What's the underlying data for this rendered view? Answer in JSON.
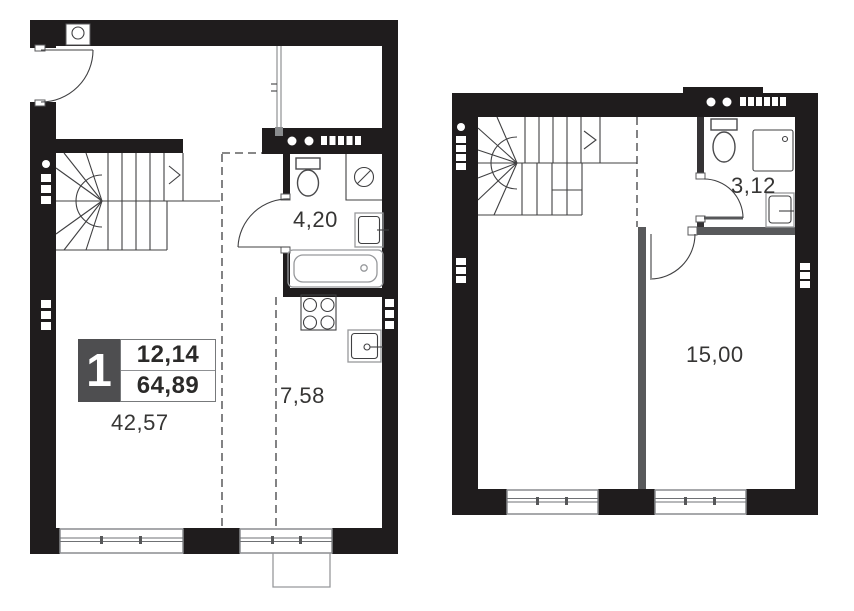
{
  "floor1": {
    "badge": {
      "unit_number": "1",
      "value_top": "12,14",
      "value_bottom": "64,89"
    },
    "living_area": "42,57",
    "kitchen_area": "7,58",
    "bathroom_area": "4,20"
  },
  "floor2": {
    "room_area": "15,00",
    "bathroom_area": "3,12"
  },
  "colors": {
    "wall_black": "#1f1c1d",
    "wall_gray": "#58595b",
    "fixture_wall": "#353335",
    "line_dark": "#404042",
    "fixture_dark": "#4a4a4c",
    "line_light": "#97999c",
    "window_frame": "#8a8c8f",
    "badge_bg": "#4e4e50",
    "text": "#363534"
  }
}
